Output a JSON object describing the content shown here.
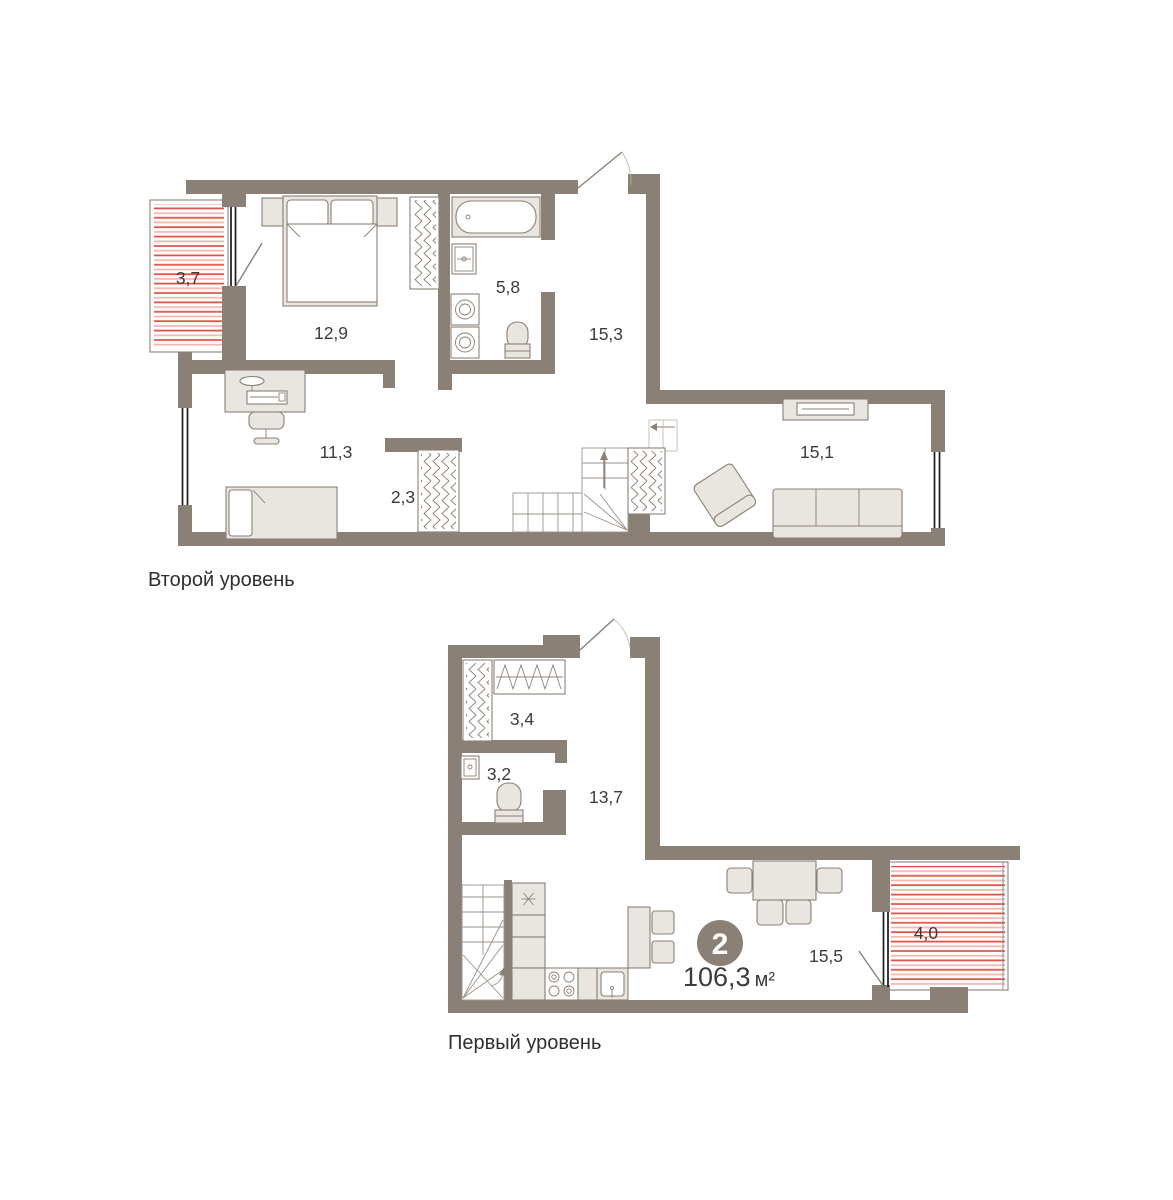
{
  "colors": {
    "wall": "#8a8076",
    "outline": "#8a8076",
    "furniture": "#e9e5e0",
    "window": "#1a1a1a",
    "balcony_stripe_dark": "#de5449",
    "balcony_stripe_light": "#f3b8b0",
    "label_text": "#3c3c3c",
    "badge_bg": "#8a8076",
    "badge_text": "#ffffff",
    "background": "#ffffff"
  },
  "levels": [
    {
      "caption": "Второй уровень",
      "areas": {
        "balcony": "3,7",
        "bedroom": "12,9",
        "bathroom": "5,8",
        "hall": "15,3",
        "room": "11,3",
        "closet": "2,3",
        "living": "15,1"
      }
    },
    {
      "caption": "Первый уровень",
      "areas": {
        "wardrobe": "3,4",
        "wc": "3,2",
        "hall": "13,7",
        "kitchen_living": "15,5",
        "balcony": "4,0"
      }
    }
  ],
  "summary": {
    "badge": "2",
    "area_value": "106,3",
    "area_unit": "м²"
  }
}
